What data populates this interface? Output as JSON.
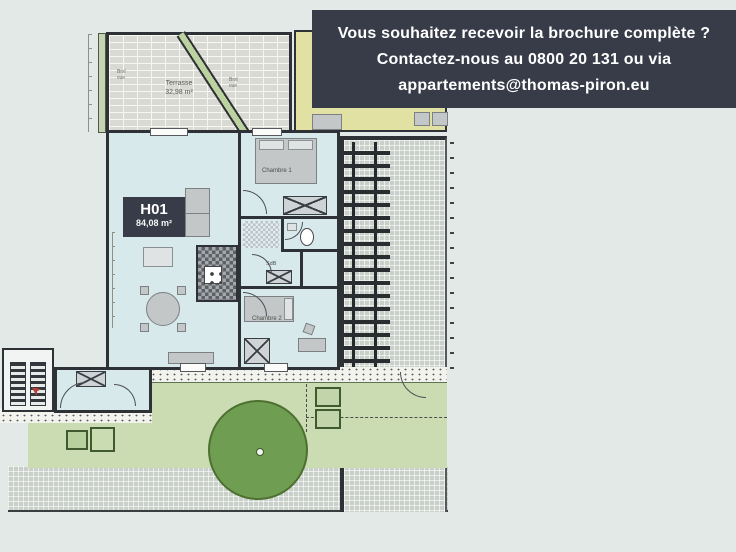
{
  "banner": {
    "lines": [
      "Vous souhaitez recevoir la brochure complète ?",
      "Contactez-nous au 0800 20 131 ou via",
      "appartements@thomas-piron.eu"
    ],
    "bg_color": "#383c48",
    "text_color": "#ffffff"
  },
  "plan": {
    "unit_code": "H01",
    "unit_area": "84,08 m²",
    "terrace_name": "Terrasse",
    "terrace_area": "32,98 m²",
    "bedroom1_label": "Chambre 1",
    "bedroom2_label": "Chambre 2",
    "bathroom_label": "SdB",
    "view_label_1": {
      "l1": "Brxl",
      "l2": "vue"
    },
    "view_label_2": {
      "l1": "Brxl",
      "l2": "vue"
    }
  },
  "colors": {
    "page_bg": "#e2e9e7",
    "interior": "#d8e9ec",
    "wall": "#2e3135",
    "garden": "#cbdcb3",
    "tree": "#6f9e52",
    "neighbor_unit": "#e0e1a3",
    "accent_red": "#b5413c"
  }
}
